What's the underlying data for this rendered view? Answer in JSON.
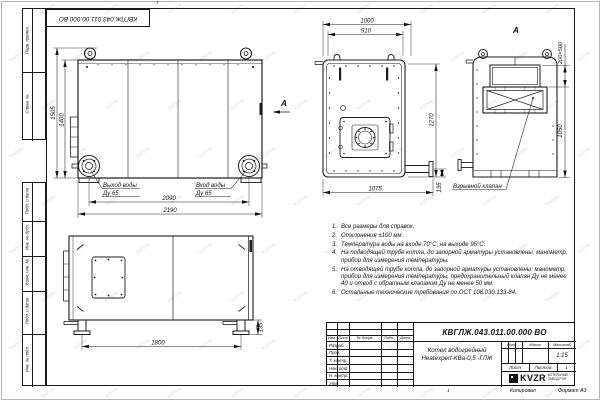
{
  "watermark": {
    "text": "КЗР.РФ"
  },
  "sheet": {
    "stamp_top": "КВГЛЖ.043.011.00.000 ВО",
    "zone_top": "1",
    "zone_bottom": "1",
    "copied_label": "Копировал",
    "format_label": "Формат А3"
  },
  "margin": {
    "top_cells": [
      "Перв. примен.",
      "Справ. №"
    ],
    "bottom_cells": [
      "Подп. и дата",
      "Инв. № дубл.",
      "Взам. инв. №",
      "Подп. и дата",
      "Инв. № подл."
    ]
  },
  "views": {
    "front": {
      "dim_height_total": "1505",
      "dim_height_body": "1400",
      "dim_width_flanges": "2090",
      "dim_width_total": "2190",
      "outlet_line1": "Выход воды",
      "outlet_line2": "Ду 65",
      "inlet_line1": "Вход воды",
      "inlet_line2": "Ду 65",
      "section_arrow_label": "А"
    },
    "plan": {
      "dim_width_total": "1000",
      "dim_width_inner": "910",
      "dim_depth": "1270",
      "dim_width_bottom": "1075",
      "dim_flange_offset": "135"
    },
    "view_a": {
      "label": "А",
      "dim_opening": "200×500",
      "dim_height": "1050",
      "valve_label": "Взрывной клапан"
    },
    "side": {
      "dim_base": "1800",
      "dim_leg_height": "135"
    }
  },
  "notes": {
    "items": [
      {
        "n": "1.",
        "text": "Все размеры для справок."
      },
      {
        "n": "2.",
        "text": "Отклонения ±100 мм."
      },
      {
        "n": "3.",
        "text": "Температура воды на входе 70°С, на выходе 95°С."
      },
      {
        "n": "4.",
        "text": "На подводящей трубе котла, до запорной арматуры установлены: манометр, прибор для измерения температуры."
      },
      {
        "n": "5.",
        "text": "На отводящей трубе котла, до запорной арматуры установлены: манометр, прибор для измерения температуры, предохранительный клапан Ду не менее 40 и отвод с обратным клапаном Ду не менее 50 мм."
      },
      {
        "n": "6.",
        "text": "Остальные технические требования по ОСТ 108.030.133-84."
      }
    ]
  },
  "title_block": {
    "doc_number": "КВГЛЖ.043.011.00.000 ВО",
    "product_name_line1": "Котел водогрейный",
    "product_name_line2": "Heatexpert-КВа-0,5 -ГЛЖ",
    "rev_headers": [
      "Изм.",
      "Лист",
      "№ докум.",
      "Подп.",
      "Дата"
    ],
    "role_rows": [
      "Разраб.",
      "Пров.",
      "Т. контр.",
      "Нач. отд.",
      "Н. контр.",
      "Утв."
    ],
    "lit_header": "Лит.",
    "mass_header": "Масса",
    "scale_header": "Масштаб",
    "scale_value": "1:15",
    "sheet_label": "Лист",
    "sheets_label": "Листов",
    "sheets_value": "1",
    "logo_text": "KVZR",
    "logo_caption_line1": "КОТЕЛЬНЫЙ",
    "logo_caption_line2": "ЗАВОД РЭП"
  }
}
